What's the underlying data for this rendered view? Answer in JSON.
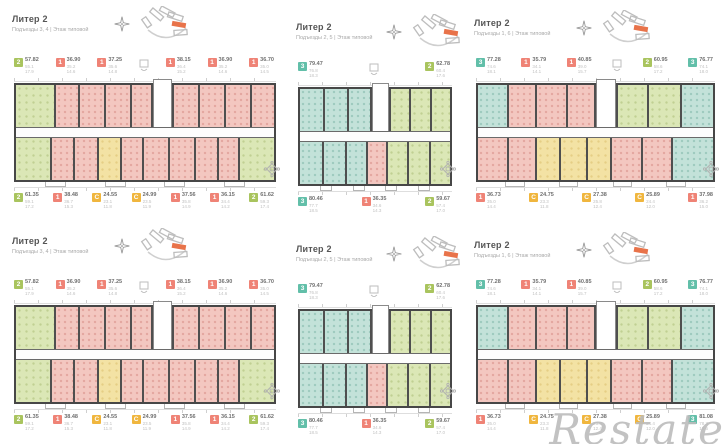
{
  "watermark": {
    "text": "Restate"
  },
  "palette": {
    "badge": {
      "1": "#ef8376",
      "2": "#a9c45e",
      "3": "#62bfa9",
      "С": "#f0b63e"
    },
    "room": {
      "pink": "pink",
      "green": "green",
      "yellow": "yellow",
      "teal": "teal",
      "core": "core"
    }
  },
  "plans": [
    {
      "col": "col1",
      "title": "Литер 2",
      "subtitle": "Подъезды 3, 4  |  Этаж типовой",
      "top_badges": [
        {
          "label": "2",
          "type": "2",
          "v1": "57.82",
          "v2": "55.1",
          "v3": "17.9"
        },
        {
          "label": "1",
          "type": "1",
          "v1": "36.90",
          "v2": "35.2",
          "v3": "14.6"
        },
        {
          "label": "1",
          "type": "1",
          "v1": "37.25",
          "v2": "35.6",
          "v3": "14.8"
        },
        {
          "type": "lift"
        },
        {
          "label": "1",
          "type": "1",
          "v1": "38.15",
          "v2": "36.4",
          "v3": "15.2"
        },
        {
          "label": "1",
          "type": "1",
          "v1": "36.90",
          "v2": "35.2",
          "v3": "14.6"
        },
        {
          "label": "1",
          "type": "1",
          "v1": "36.70",
          "v2": "35.0",
          "v3": "14.5"
        }
      ],
      "bottom_badges": [
        {
          "label": "2",
          "type": "2",
          "v1": "61.35",
          "v2": "59.1",
          "v3": "17.2"
        },
        {
          "label": "1",
          "type": "1",
          "v1": "38.48",
          "v2": "36.7",
          "v3": "15.3"
        },
        {
          "label": "С",
          "type": "С",
          "v1": "24.55",
          "v2": "23.1",
          "v3": "11.8"
        },
        {
          "label": "С",
          "type": "С",
          "v1": "24.99",
          "v2": "23.5",
          "v3": "11.9"
        },
        {
          "label": "1",
          "type": "1",
          "v1": "37.56",
          "v2": "35.8",
          "v3": "14.9"
        },
        {
          "label": "1",
          "type": "1",
          "v1": "36.15",
          "v2": "34.4",
          "v3": "14.2"
        },
        {
          "label": "2",
          "type": "2",
          "v1": "61.62",
          "v2": "59.3",
          "v3": "17.4"
        }
      ],
      "rooms_top": [
        [
          "green",
          16
        ],
        [
          "pink",
          9
        ],
        [
          "pink",
          10
        ],
        [
          "pink",
          10
        ],
        [
          "pink",
          8
        ],
        [
          "core",
          8
        ],
        [
          "pink",
          10
        ],
        [
          "pink",
          10
        ],
        [
          "pink",
          10
        ],
        [
          "pink",
          9
        ]
      ],
      "rooms_bottom": [
        [
          "green",
          14
        ],
        [
          "pink",
          9
        ],
        [
          "pink",
          9
        ],
        [
          "yellow",
          9
        ],
        [
          "pink",
          8
        ],
        [
          "pink",
          10
        ],
        [
          "pink",
          10
        ],
        [
          "pink",
          9
        ],
        [
          "pink",
          8
        ],
        [
          "green",
          14
        ]
      ]
    },
    {
      "col": "col2",
      "title": "Литер 2",
      "subtitle": "Подъезды 2, 5  |  Этаж типовой",
      "top_badges": [
        {
          "label": "3",
          "type": "3",
          "v1": "79.47",
          "v2": "76.8",
          "v3": "18.3"
        },
        {
          "type": "lift"
        },
        {
          "label": "2",
          "type": "2",
          "v1": "62.78",
          "v2": "60.4",
          "v3": "17.6"
        }
      ],
      "bottom_badges": [
        {
          "label": "3",
          "type": "3",
          "v1": "80.46",
          "v2": "77.7",
          "v3": "18.5"
        },
        {
          "label": "1",
          "type": "1",
          "v1": "36.35",
          "v2": "34.6",
          "v3": "14.3"
        },
        {
          "label": "2",
          "type": "2",
          "v1": "59.67",
          "v2": "57.4",
          "v3": "17.0"
        }
      ],
      "rooms_top": [
        [
          "teal",
          17
        ],
        [
          "teal",
          16
        ],
        [
          "teal",
          15
        ],
        [
          "core",
          12
        ],
        [
          "green",
          13
        ],
        [
          "green",
          14
        ],
        [
          "green",
          13
        ]
      ],
      "rooms_bottom": [
        [
          "teal",
          16
        ],
        [
          "teal",
          15
        ],
        [
          "teal",
          14
        ],
        [
          "pink",
          13
        ],
        [
          "green",
          14
        ],
        [
          "green",
          14
        ],
        [
          "green",
          14
        ]
      ]
    },
    {
      "col": "col3",
      "title": "Литер 2",
      "subtitle": "Подъезды 1, 6  |  Этаж типовой",
      "top_badges": [
        {
          "label": "3",
          "type": "3",
          "v1": "77.28",
          "v2": "74.6",
          "v3": "18.1"
        },
        {
          "label": "1",
          "type": "1",
          "v1": "35.79",
          "v2": "34.1",
          "v3": "14.1"
        },
        {
          "label": "1",
          "type": "1",
          "v1": "40.85",
          "v2": "39.0",
          "v3": "15.7"
        },
        {
          "type": "lift"
        },
        {
          "label": "2",
          "type": "2",
          "v1": "60.95",
          "v2": "58.6",
          "v3": "17.2"
        },
        {
          "label": "3",
          "type": "3",
          "v1": "76.77",
          "v2": "74.1",
          "v3": "18.0"
        }
      ],
      "bottom_badges": [
        {
          "label": "1",
          "type": "1",
          "v1": "36.73",
          "v2": "35.0",
          "v3": "14.4"
        },
        {
          "label": "С",
          "type": "С",
          "v1": "24.75",
          "v2": "23.3",
          "v3": "11.8"
        },
        {
          "label": "С",
          "type": "С",
          "v1": "27.38",
          "v2": "25.8",
          "v3": "12.4"
        },
        {
          "label": "С",
          "type": "С",
          "v1": "25.89",
          "v2": "24.4",
          "v3": "12.0"
        },
        {
          "label": "1",
          "type": "1",
          "v1": "37.98",
          "v2": "36.2",
          "v3": "15.0"
        }
      ],
      "rooms_top": [
        [
          "teal",
          13
        ],
        [
          "pink",
          12
        ],
        [
          "pink",
          13
        ],
        [
          "pink",
          12
        ],
        [
          "core",
          9
        ],
        [
          "green",
          13
        ],
        [
          "green",
          14
        ],
        [
          "teal",
          14
        ]
      ],
      "rooms_bottom": [
        [
          "pink",
          13
        ],
        [
          "pink",
          12
        ],
        [
          "yellow",
          10
        ],
        [
          "yellow",
          11
        ],
        [
          "yellow",
          10
        ],
        [
          "pink",
          13
        ],
        [
          "pink",
          13
        ],
        [
          "teal",
          18
        ]
      ]
    },
    {
      "col": "col1",
      "title": "Литер 2",
      "subtitle": "Подъезды 3, 4  |  Этаж типовой",
      "top_badges": [
        {
          "label": "2",
          "type": "2",
          "v1": "57.82",
          "v2": "55.1",
          "v3": "17.9"
        },
        {
          "label": "1",
          "type": "1",
          "v1": "36.90",
          "v2": "35.2",
          "v3": "14.6"
        },
        {
          "label": "1",
          "type": "1",
          "v1": "37.25",
          "v2": "35.6",
          "v3": "14.8"
        },
        {
          "type": "lift"
        },
        {
          "label": "1",
          "type": "1",
          "v1": "38.15",
          "v2": "36.4",
          "v3": "15.2"
        },
        {
          "label": "1",
          "type": "1",
          "v1": "36.90",
          "v2": "35.2",
          "v3": "14.6"
        },
        {
          "label": "1",
          "type": "1",
          "v1": "36.70",
          "v2": "35.0",
          "v3": "14.5"
        }
      ],
      "bottom_badges": [
        {
          "label": "2",
          "type": "2",
          "v1": "61.35",
          "v2": "59.1",
          "v3": "17.2"
        },
        {
          "label": "1",
          "type": "1",
          "v1": "38.48",
          "v2": "36.7",
          "v3": "15.3"
        },
        {
          "label": "С",
          "type": "С",
          "v1": "24.55",
          "v2": "23.1",
          "v3": "11.8"
        },
        {
          "label": "С",
          "type": "С",
          "v1": "24.99",
          "v2": "23.5",
          "v3": "11.9"
        },
        {
          "label": "1",
          "type": "1",
          "v1": "37.56",
          "v2": "35.8",
          "v3": "14.9"
        },
        {
          "label": "1",
          "type": "1",
          "v1": "36.15",
          "v2": "34.4",
          "v3": "14.2"
        },
        {
          "label": "2",
          "type": "2",
          "v1": "61.62",
          "v2": "59.3",
          "v3": "17.4"
        }
      ],
      "rooms_top": [
        [
          "green",
          16
        ],
        [
          "pink",
          9
        ],
        [
          "pink",
          10
        ],
        [
          "pink",
          10
        ],
        [
          "pink",
          8
        ],
        [
          "core",
          8
        ],
        [
          "pink",
          10
        ],
        [
          "pink",
          10
        ],
        [
          "pink",
          10
        ],
        [
          "pink",
          9
        ]
      ],
      "rooms_bottom": [
        [
          "green",
          14
        ],
        [
          "pink",
          9
        ],
        [
          "pink",
          9
        ],
        [
          "yellow",
          9
        ],
        [
          "pink",
          8
        ],
        [
          "pink",
          10
        ],
        [
          "pink",
          10
        ],
        [
          "pink",
          9
        ],
        [
          "pink",
          8
        ],
        [
          "green",
          14
        ]
      ]
    },
    {
      "col": "col2",
      "title": "Литер 2",
      "subtitle": "Подъезды 2, 5  |  Этаж типовой",
      "top_badges": [
        {
          "label": "3",
          "type": "3",
          "v1": "79.47",
          "v2": "76.8",
          "v3": "18.3"
        },
        {
          "type": "lift"
        },
        {
          "label": "2",
          "type": "2",
          "v1": "62.78",
          "v2": "60.4",
          "v3": "17.6"
        }
      ],
      "bottom_badges": [
        {
          "label": "3",
          "type": "3",
          "v1": "80.46",
          "v2": "77.7",
          "v3": "18.5"
        },
        {
          "label": "1",
          "type": "1",
          "v1": "36.35",
          "v2": "34.6",
          "v3": "14.3"
        },
        {
          "label": "2",
          "type": "2",
          "v1": "59.67",
          "v2": "57.4",
          "v3": "17.0"
        }
      ],
      "rooms_top": [
        [
          "teal",
          17
        ],
        [
          "teal",
          16
        ],
        [
          "teal",
          15
        ],
        [
          "core",
          12
        ],
        [
          "green",
          13
        ],
        [
          "green",
          14
        ],
        [
          "green",
          13
        ]
      ],
      "rooms_bottom": [
        [
          "teal",
          16
        ],
        [
          "teal",
          15
        ],
        [
          "teal",
          14
        ],
        [
          "pink",
          13
        ],
        [
          "green",
          14
        ],
        [
          "green",
          14
        ],
        [
          "green",
          14
        ]
      ]
    },
    {
      "col": "col3",
      "title": "Литер 2",
      "subtitle": "Подъезды 1, 6  |  Этаж типовой",
      "top_badges": [
        {
          "label": "3",
          "type": "3",
          "v1": "77.28",
          "v2": "74.6",
          "v3": "18.1"
        },
        {
          "label": "1",
          "type": "1",
          "v1": "35.79",
          "v2": "34.1",
          "v3": "14.1"
        },
        {
          "label": "1",
          "type": "1",
          "v1": "40.85",
          "v2": "39.0",
          "v3": "15.7"
        },
        {
          "type": "lift"
        },
        {
          "label": "2",
          "type": "2",
          "v1": "60.95",
          "v2": "58.6",
          "v3": "17.2"
        },
        {
          "label": "3",
          "type": "3",
          "v1": "76.77",
          "v2": "74.1",
          "v3": "18.0"
        }
      ],
      "bottom_badges": [
        {
          "label": "1",
          "type": "1",
          "v1": "36.73",
          "v2": "35.0",
          "v3": "14.4"
        },
        {
          "label": "С",
          "type": "С",
          "v1": "24.75",
          "v2": "23.3",
          "v3": "11.8"
        },
        {
          "label": "С",
          "type": "С",
          "v1": "27.38",
          "v2": "25.8",
          "v3": "12.4"
        },
        {
          "label": "С",
          "type": "С",
          "v1": "25.89",
          "v2": "24.4",
          "v3": "12.0"
        },
        {
          "label": "3",
          "type": "3",
          "v1": "81.08",
          "v2": "78.3",
          "v3": "18.6"
        }
      ],
      "rooms_top": [
        [
          "teal",
          13
        ],
        [
          "pink",
          12
        ],
        [
          "pink",
          13
        ],
        [
          "pink",
          12
        ],
        [
          "core",
          9
        ],
        [
          "green",
          13
        ],
        [
          "green",
          14
        ],
        [
          "teal",
          14
        ]
      ],
      "rooms_bottom": [
        [
          "pink",
          13
        ],
        [
          "pink",
          12
        ],
        [
          "yellow",
          10
        ],
        [
          "yellow",
          11
        ],
        [
          "yellow",
          10
        ],
        [
          "pink",
          13
        ],
        [
          "pink",
          13
        ],
        [
          "teal",
          18
        ]
      ]
    }
  ]
}
